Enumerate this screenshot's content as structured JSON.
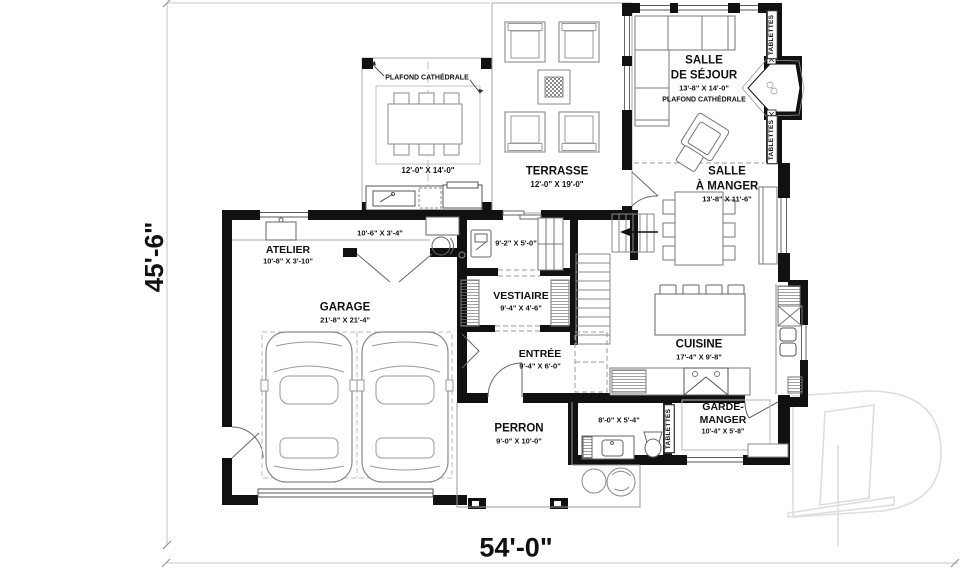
{
  "plan_title": "floor-plan",
  "overall_dimensions": {
    "height": "45'-6\"",
    "width": "54'-0\""
  },
  "rooms": {
    "couvert": {
      "note": "PLAFOND CATHÉDRALE",
      "dims": "12'-0\" X 14'-0\""
    },
    "terrasse": {
      "name": "TERRASSE",
      "dims": "12'-0\" X 19'-0\""
    },
    "sejour": {
      "name_line1": "SALLE",
      "name_line2": "DE SÉJOUR",
      "dims": "13'-8\" X 14'-0\"",
      "note": "PLAFOND CATHÉDRALE"
    },
    "manger": {
      "name_line1": "SALLE",
      "name_line2": "À MANGER",
      "dims": "13'-8\" X 11'-6\""
    },
    "atelier": {
      "name": "ATELIER",
      "dims": "10'-8\" X 3'-10\""
    },
    "nook": {
      "dims": "10'-6\" X 3'-4\""
    },
    "laundry": {
      "dims": "9'-2\" X 5'-0\""
    },
    "garage": {
      "name": "GARAGE",
      "dims": "21'-8\" X 21'-4\""
    },
    "vestiaire": {
      "name": "VESTIAIRE",
      "dims": "9'-4\" X 4'-6\""
    },
    "entree": {
      "name": "ENTRÉE",
      "dims": "9'-4\" X 6'-0\""
    },
    "cuisine": {
      "name": "CUISINE",
      "dims": "17'-4\" X 9'-8\""
    },
    "perron": {
      "name": "PERRON",
      "dims": "9'-0\" X 10'-0\""
    },
    "bain": {
      "dims": "8'-0\" X 5'-4\""
    },
    "garde_manger": {
      "name_line1": "GARDE-",
      "name_line2": "MANGER",
      "dims": "10'-4\" X 5'-8\""
    }
  },
  "labels": {
    "tablettes": "TABLETTES"
  },
  "colors": {
    "wall": "#111111",
    "thin_line": "#777777",
    "light_line": "#aaaaaa",
    "dim_line": "#c8c8c8",
    "watermark": "#dedede"
  }
}
